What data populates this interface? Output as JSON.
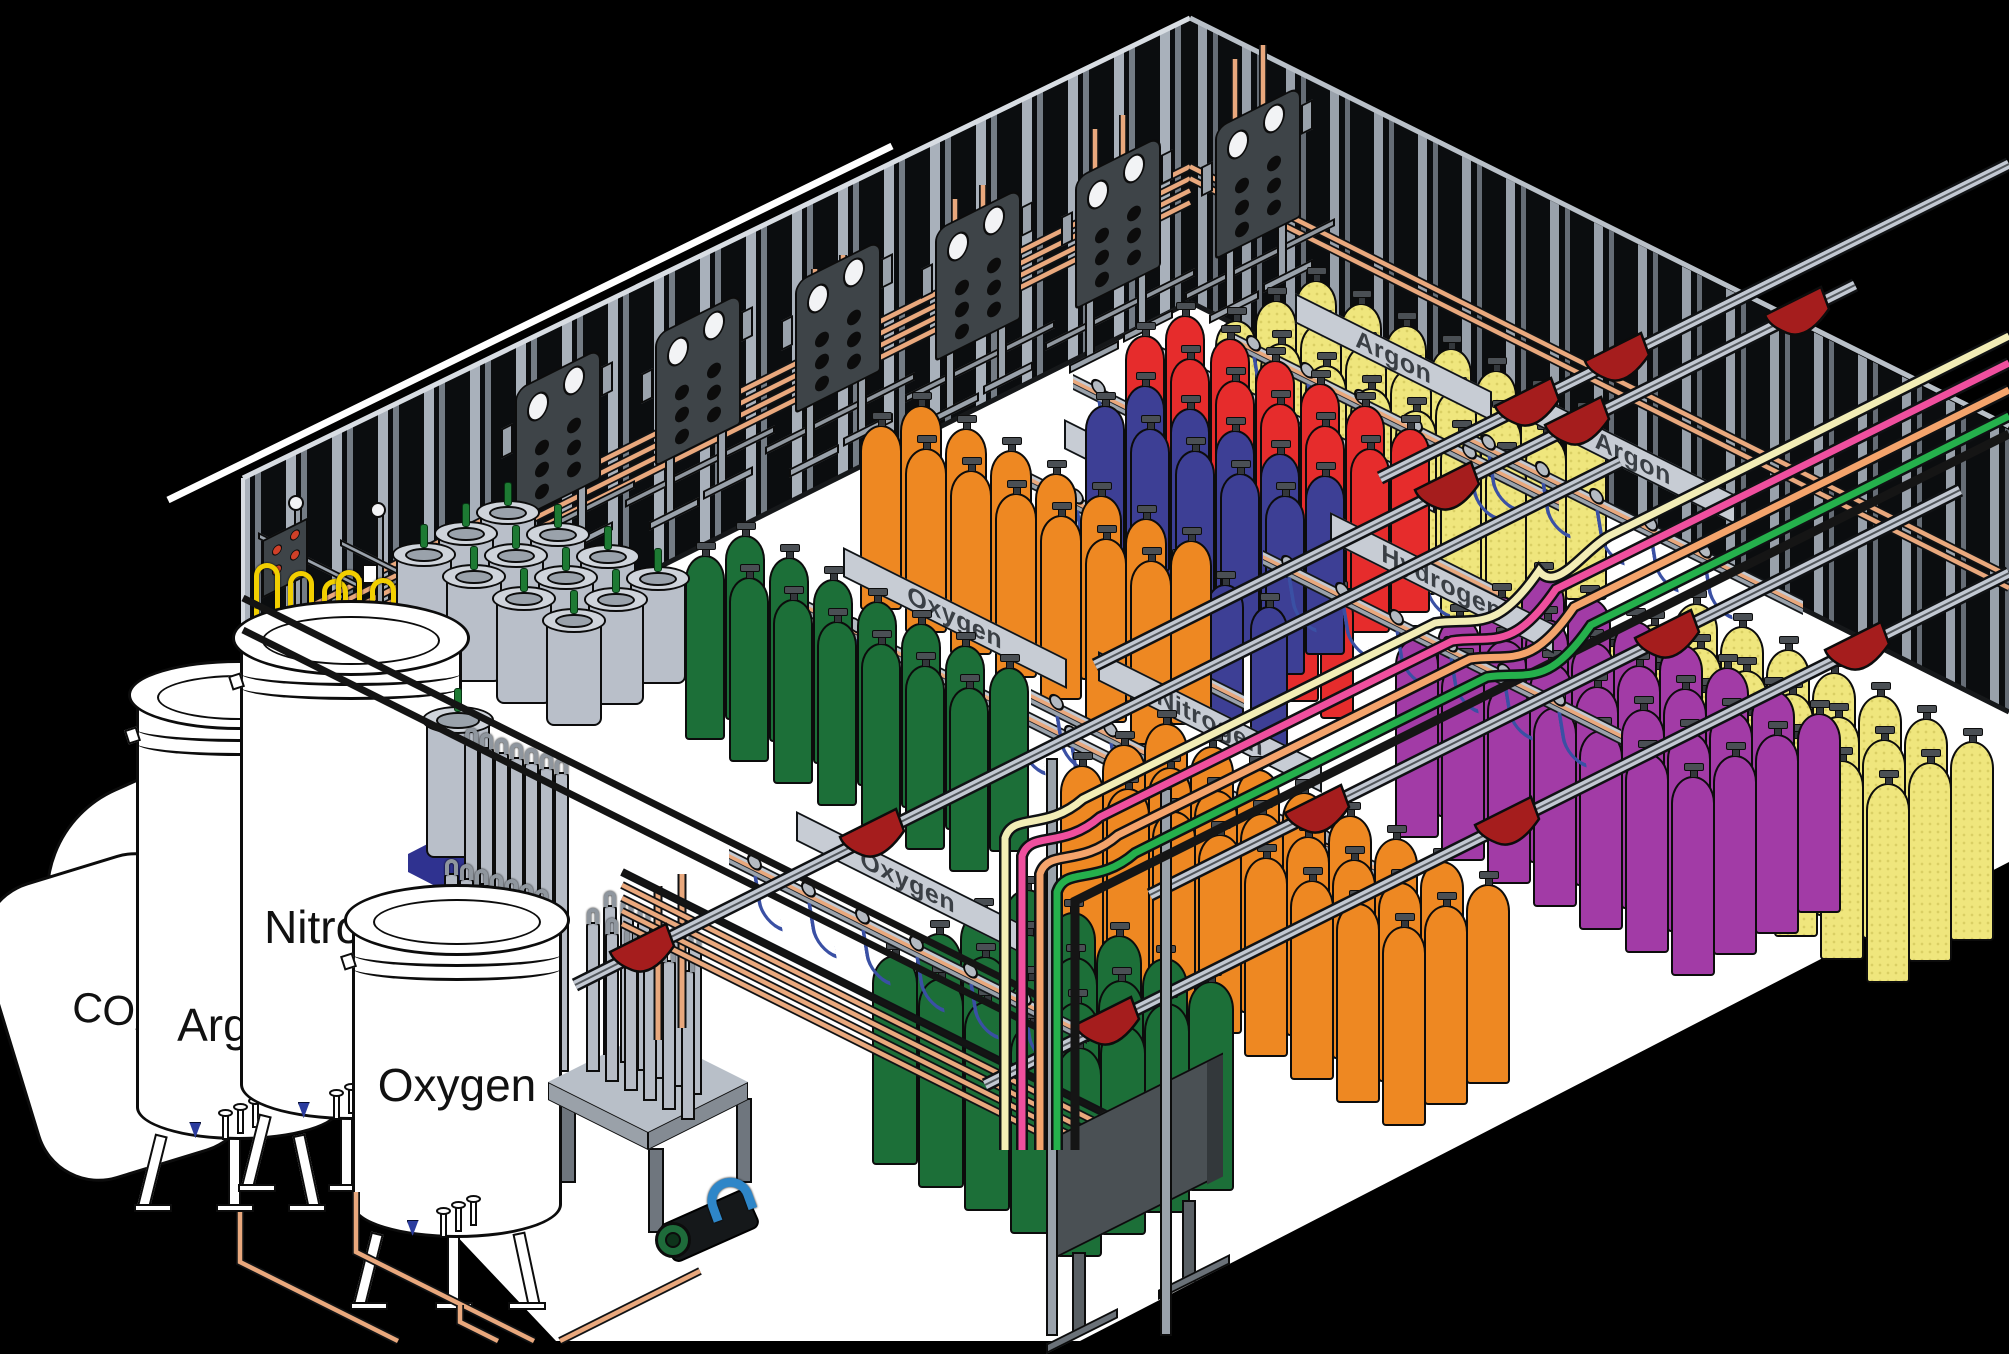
{
  "storage_tanks": [
    {
      "id": "co2-tank",
      "label": "CO₂"
    },
    {
      "id": "argon-tank",
      "label": "Argon"
    },
    {
      "id": "nitrogen-tank",
      "label": "Nitrogen"
    },
    {
      "id": "oxygen-tank",
      "label": "Oxygen"
    }
  ],
  "fill_racks": [
    {
      "id": "argon-rack-top",
      "label": "Argon",
      "cylinder_color": "#efe67d"
    },
    {
      "id": "carbon-dioxide-rack",
      "label": "Carbon Dioxide",
      "cylinder_color": "#efe67d"
    },
    {
      "id": "helium-rack",
      "label": "Helium",
      "cylinder_color": "#e62c2c"
    },
    {
      "id": "nitrogen-rack-left",
      "label": "Nitrogen",
      "cylinder_color": "#3d3f95"
    },
    {
      "id": "oxygen-rack-left",
      "label": "Oxygen",
      "cylinder_color": "#1c6f38"
    },
    {
      "id": "argon-rack-right",
      "label": "Argon",
      "cylinder_color": "#efe67d"
    },
    {
      "id": "hydrogen-rack",
      "label": "Hydrogen",
      "cylinder_color": "#a23ba6"
    },
    {
      "id": "nitrogen-rack-right",
      "label": "Nitrogen",
      "cylinder_color": "#ee8822"
    },
    {
      "id": "oxygen-rack-bottom",
      "label": "Oxygen",
      "cylinder_color": "#1c6f38"
    }
  ],
  "cylinder_groups": [
    {
      "id": "yellow-top",
      "gas": "carbon dioxide / argon",
      "color": "#efe67d",
      "count": 21
    },
    {
      "id": "red-helium",
      "gas": "helium",
      "color": "#e62c2c",
      "count": 14
    },
    {
      "id": "blue-nitrogen",
      "gas": "nitrogen",
      "color": "#3d3f95",
      "count": 13
    },
    {
      "id": "orange-mid",
      "gas": "nitrogen",
      "color": "#ee8822",
      "count": 14
    },
    {
      "id": "green-oxygen",
      "gas": "oxygen",
      "color": "#1c6f38",
      "count": 14
    },
    {
      "id": "yellow-right",
      "gas": "argon",
      "color": "#efe67d",
      "count": 21
    },
    {
      "id": "purple-hydrogen",
      "gas": "hydrogen",
      "color": "#a23ba6",
      "count": 28
    },
    {
      "id": "orange-bottom",
      "gas": "nitrogen",
      "color": "#ee8822",
      "count": 24
    },
    {
      "id": "green-bottom",
      "gas": "oxygen",
      "color": "#1c6f38",
      "count": 20
    }
  ],
  "equipment": {
    "dewar_count": 13,
    "tube_rack_tubes": 14,
    "vaporizer_tubes": 12,
    "manifold_panels": 6,
    "hoist_trolleys": 12
  },
  "hose_lines": [
    {
      "name": "cream",
      "color": "#f2edb6"
    },
    {
      "name": "pink",
      "color": "#ef4f9e"
    },
    {
      "name": "peach",
      "color": "#f4a46c"
    },
    {
      "name": "green",
      "color": "#25b04c"
    }
  ],
  "colors": {
    "background": "#000000",
    "floor": "#ffffff",
    "wall_light": "#a9b1bb",
    "wall_mid": "#747c85",
    "wall_dark": "#0b0d0f",
    "copper": "#e9a87d",
    "steel_light": "#c3c9d1",
    "steel_mid": "#9aa2ab",
    "steel_dark": "#4a5054",
    "panel": "#3e4448",
    "trolley": "#a51d1d",
    "fill_hose_blue": "#3a50a4",
    "pallet_blue": "#2f3290",
    "valve_green": "#1d7a33",
    "dewar_gray": "#b9bfc9",
    "station_yellow": "#f2cf00",
    "tank_white": "#ffffff",
    "outline": "#0a0a0a"
  }
}
